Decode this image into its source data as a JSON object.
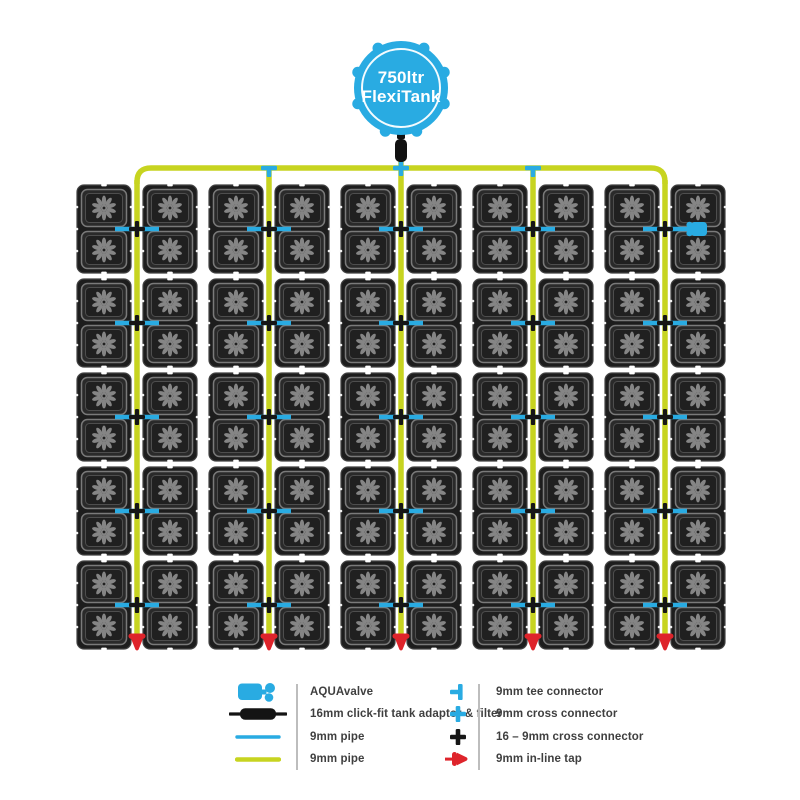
{
  "tank": {
    "line1": "750ltr",
    "line2": "FlexiTank"
  },
  "grid": {
    "rows": 5,
    "columns": 10,
    "pots_per_tray": 2,
    "tray_pairs_per_row": 5,
    "vertical_feed_pipes": 5,
    "aquavalve_tray": {
      "row": 1,
      "column": 10
    }
  },
  "legend": {
    "left": [
      {
        "icon": "aquavalve-icon",
        "label": "AQUAvalve"
      },
      {
        "icon": "tank-adaptor-icon",
        "label": "16mm click-fit tank adaptor & filter"
      },
      {
        "icon": "blue-pipe-icon",
        "label": "9mm pipe"
      },
      {
        "icon": "yellow-pipe-icon",
        "label": "9mm pipe"
      }
    ],
    "right": [
      {
        "icon": "tee-connector-icon",
        "label": "9mm tee connector"
      },
      {
        "icon": "cross-connector-icon",
        "label": "9mm cross connector"
      },
      {
        "icon": "cross-connector-16-9-icon",
        "label": "16 – 9mm cross connector"
      },
      {
        "icon": "inline-tap-icon",
        "label": "9mm in-line tap"
      }
    ]
  },
  "colors": {
    "blue": "#29abe2",
    "yellow": "#c7d420",
    "red": "#de242b",
    "tray_fill": "#1d1d1d",
    "tray_stroke": "#424242",
    "pot_fill": "#2a2a2a",
    "pot_stroke": "#7a7a7a",
    "pot_inner_fill": "#202020",
    "pot_inner_stroke": "#4e4e4e",
    "flower": "#858585",
    "connector_black": "#161616",
    "legend_text": "#3f3f3f",
    "divider": "#bdbdbd",
    "background": "#ffffff"
  }
}
